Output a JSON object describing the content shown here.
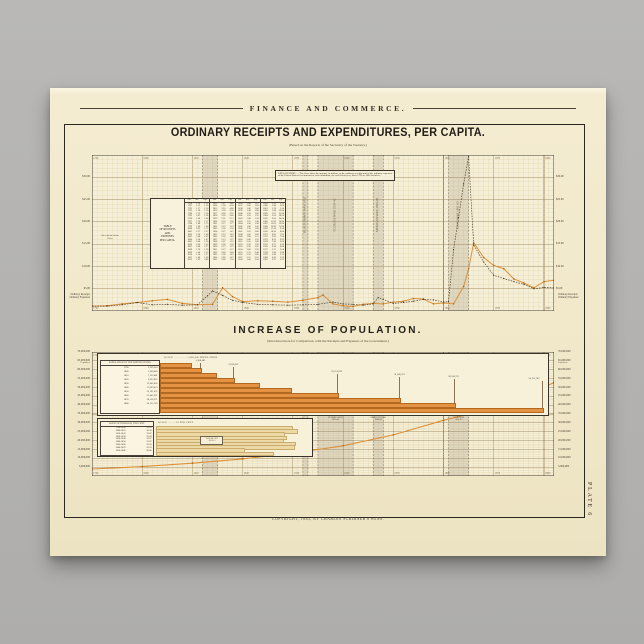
{
  "poster": {
    "running_head": "FINANCE AND COMMERCE.",
    "title": "ORDINARY RECEIPTS AND EXPENDITURES, PER CAPITA.",
    "title_subtitle": "(Based on the Reports of the Secretary of the Treasury.)",
    "section2_title": "INCREASE OF POPULATION.",
    "section2_subtitle": "(Introduced here for Comparison, with the Receipts and Expenses of the Government.)",
    "copyright": "COPYRIGHT, 1883, BY CHARLES SCRIBNER'S SONS.",
    "plate_label": "PLATE 6",
    "left_series_caption": [
      "Ordinary Receipts",
      "Ordinary Expenses"
    ],
    "right_series_caption": [
      "Ordinary Receipts",
      "Ordinary Expenses"
    ]
  },
  "colors": {
    "backdrop": "#b4b3b1",
    "paper": "#f2e9cb",
    "chart_bg": "#f6efd7",
    "grid_minor": "#e0d2aa",
    "grid_major": "#a08c64",
    "ink": "#2b2620",
    "receipts_orange": "#d9923c",
    "expenses_brown": "#57472f",
    "bar_orange": "#e59243",
    "bar_tan": "#ecd9a6",
    "band_gray": "rgba(110,100,84,0.17)"
  },
  "chart_data": [
    {
      "id": "per-capita",
      "type": "line",
      "title": "ORDINARY RECEIPTS AND EXPENDITURES, PER CAPITA.",
      "xlabel": "Year",
      "ylabel": "Dollars per inhabitant",
      "x_range": [
        1790,
        1882
      ],
      "y_range": [
        0,
        35
      ],
      "x_ticks": [
        1790,
        1800,
        1810,
        1820,
        1830,
        1840,
        1850,
        1860,
        1870,
        1880
      ],
      "y_ticks": [
        {
          "v": 30,
          "label": "$30.00"
        },
        {
          "v": 25,
          "label": "$25.00"
        },
        {
          "v": 20,
          "label": "$20.00"
        },
        {
          "v": 15,
          "label": "$15.00"
        },
        {
          "v": 10,
          "label": "$10.00"
        },
        {
          "v": 5,
          "label": "$5.00"
        }
      ],
      "explanation": "EXPLANATION. — The lines show the amount, in dollars, of the ordinary receipts and of the ordinary expenses of the United States Government for each inhabitant, for each fiscal year, from 1790 to 1882 inclusive.",
      "annotation": "War with the Indian Tribes",
      "war_bands": [
        {
          "label": "WAR OF 1812",
          "dates": "1812-15",
          "from": 1812,
          "to": 1815,
          "label_pos": "box"
        },
        {
          "label": "BLACK HAWK WAR",
          "dates": "1832",
          "from": 1832,
          "to": 1833,
          "label_pos": "none"
        },
        {
          "label": "FLORIDA WAR",
          "dates": "1835-42",
          "from": 1835,
          "to": 1842,
          "label_pos": "strip"
        },
        {
          "label": "MEXICAN WAR",
          "dates": "1846-48",
          "from": 1846,
          "to": 1848,
          "label_pos": "strip"
        },
        {
          "label": "CIVIL WAR",
          "dates": "1861-65",
          "from": 1861,
          "to": 1865,
          "label_pos": "strip"
        }
      ],
      "table": {
        "title_lines": [
          "TABLE",
          "OF RECEIPTS",
          "AND",
          "EXPENSES",
          "PER CAPITA."
        ],
        "columns": [
          "Year",
          "Rec.",
          "Exp."
        ],
        "year_start": 1790,
        "rows_per_group": 23,
        "groups": 4
      },
      "series": [
        {
          "name": "Ordinary Receipts",
          "style": "solid",
          "x": [
            1790,
            1793,
            1796,
            1799,
            1802,
            1805,
            1808,
            1811,
            1814,
            1816,
            1818,
            1820,
            1823,
            1826,
            1829,
            1832,
            1835,
            1836,
            1838,
            1840,
            1842,
            1844,
            1846,
            1848,
            1850,
            1852,
            1854,
            1856,
            1858,
            1860,
            1862,
            1864,
            1865,
            1866,
            1868,
            1870,
            1872,
            1874,
            1876,
            1878,
            1880,
            1882
          ],
          "y": [
            1.1,
            1.2,
            1.6,
            1.9,
            2.3,
            2.6,
            1.7,
            1.4,
            1.5,
            5.2,
            3.2,
            2.1,
            2.3,
            2.2,
            2.0,
            2.4,
            3.0,
            3.6,
            1.6,
            1.2,
            1.0,
            1.5,
            1.7,
            1.6,
            2.0,
            2.2,
            2.8,
            2.7,
            1.6,
            1.8,
            1.6,
            5.5,
            9.5,
            15.3,
            12.0,
            10.2,
            9.5,
            7.2,
            6.3,
            5.2,
            6.6,
            6.9
          ]
        },
        {
          "name": "Ordinary Expenses",
          "style": "dotted",
          "x": [
            1790,
            1793,
            1796,
            1799,
            1802,
            1805,
            1808,
            1811,
            1813,
            1814,
            1816,
            1818,
            1820,
            1823,
            1826,
            1829,
            1832,
            1835,
            1838,
            1840,
            1842,
            1844,
            1846,
            1847,
            1848,
            1850,
            1852,
            1854,
            1856,
            1858,
            1860,
            1861,
            1862,
            1863,
            1864,
            1865,
            1866,
            1868,
            1870,
            1872,
            1874,
            1876,
            1878,
            1880,
            1882
          ],
          "y": [
            1.1,
            1.1,
            1.4,
            1.9,
            1.4,
            1.5,
            1.3,
            1.4,
            3.4,
            4.5,
            3.5,
            2.4,
            1.9,
            1.5,
            1.4,
            1.3,
            1.4,
            1.5,
            2.0,
            1.6,
            1.5,
            1.3,
            1.6,
            3.0,
            2.6,
            1.7,
            1.9,
            2.2,
            2.6,
            2.5,
            2.0,
            2.1,
            13.8,
            21.0,
            28.5,
            34.6,
            14.8,
            11.0,
            8.0,
            7.3,
            6.6,
            6.0,
            5.0,
            5.3,
            5.2
          ]
        }
      ]
    },
    {
      "id": "population",
      "type": "line",
      "title": "INCREASE OF POPULATION.",
      "x_range": [
        1790,
        1882
      ],
      "y_range": [
        0,
        70000000
      ],
      "x_ticks": [
        1790,
        1800,
        1810,
        1820,
        1830,
        1840,
        1850,
        1860,
        1870,
        1880
      ],
      "y_ticks": [
        {
          "v": 70000000,
          "label": "70,000,000"
        },
        {
          "v": 65000000,
          "label": "65,000,000",
          "sub": "Population"
        },
        {
          "v": 60000000,
          "label": "60,000,000"
        },
        {
          "v": 55000000,
          "label": "55,000,000"
        },
        {
          "v": 50000000,
          "label": "50,000,000"
        },
        {
          "v": 45000000,
          "label": "45,000,000"
        },
        {
          "v": 40000000,
          "label": "40,000,000"
        },
        {
          "v": 35000000,
          "label": "35,000,000"
        },
        {
          "v": 30000000,
          "label": "30,000,000"
        },
        {
          "v": 25000000,
          "label": "25,000,000"
        },
        {
          "v": 20000000,
          "label": "20,000,000"
        },
        {
          "v": 15000000,
          "label": "15,000,000"
        },
        {
          "v": 10000000,
          "label": "10,000,000"
        },
        {
          "v": 5000000,
          "label": "5,000,000"
        }
      ],
      "war_bands": [
        {
          "label": "WAR OF 1812",
          "dates": "1812-15",
          "from": 1812,
          "to": 1815,
          "label_pos": "box"
        },
        {
          "label": "BLACK HAWK WAR",
          "dates": "1832",
          "from": 1832,
          "to": 1833,
          "label_pos": "none"
        },
        {
          "label": "FLORIDA WAR",
          "dates": "1835-42",
          "from": 1835,
          "to": 1842,
          "label_pos": "strip"
        },
        {
          "label": "MEXICAN WAR",
          "dates": "1846-48",
          "from": 1846,
          "to": 1848,
          "label_pos": "strip"
        },
        {
          "label": "CIVIL WAR",
          "dates": "1861-65",
          "from": 1861,
          "to": 1865,
          "label_pos": "strip"
        }
      ],
      "curve": {
        "name": "Population of the United States",
        "x": [
          1790,
          1800,
          1810,
          1820,
          1830,
          1840,
          1850,
          1860,
          1870,
          1880,
          1882
        ],
        "y": [
          3929214,
          5308483,
          7239881,
          9633822,
          12866020,
          17069453,
          23191876,
          31443321,
          38558371,
          50155783,
          52800000
        ]
      },
      "population_table": {
        "title": "POPULATION OF THE UNITED STATES.",
        "columns": [
          "Year",
          "Population"
        ],
        "rows": [
          [
            "1790",
            "3,929,214"
          ],
          [
            "1800",
            "5,308,483"
          ],
          [
            "1810",
            "7,239,881"
          ],
          [
            "1820",
            "9,633,822"
          ],
          [
            "1830",
            "12,866,020"
          ],
          [
            "1840",
            "17,069,453"
          ],
          [
            "1850",
            "23,191,876"
          ],
          [
            "1860",
            "31,443,321"
          ],
          [
            "1870",
            "38,558,371"
          ],
          [
            "1880",
            "50,155,783"
          ]
        ]
      },
      "bar_scale_note": "SCALE ·········· = 1,000,000 POPULATION.",
      "bar_labels": [
        {
          "year": 1800,
          "label": "5,308,483"
        },
        {
          "year": 1820,
          "label": "9,633,822"
        },
        {
          "year": 1850,
          "label": "23,191,876"
        },
        {
          "year": 1860,
          "label": "31,443,321"
        },
        {
          "year": 1870,
          "label": "38,558,371"
        },
        {
          "year": 1880,
          "label": "50,155,783"
        }
      ],
      "ratio_table": {
        "title": "RATIO OF INCREASE, PER CENT.",
        "columns": [
          "Years",
          "Per Ct."
        ],
        "rows": [
          [
            "1790-1800",
            "35.10"
          ],
          [
            "1800-1810",
            "36.38"
          ],
          [
            "1810-1820",
            "33.07"
          ],
          [
            "1820-1830",
            "33.49"
          ],
          [
            "1830-1840",
            "32.67"
          ],
          [
            "1840-1850",
            "35.87"
          ],
          [
            "1850-1860",
            "35.58"
          ],
          [
            "1860-1870",
            "22.63"
          ],
          [
            "1870-1880",
            "30.08"
          ]
        ]
      },
      "ratio_scale_note": "SCALE ····· = 10 PER CENT."
    }
  ]
}
